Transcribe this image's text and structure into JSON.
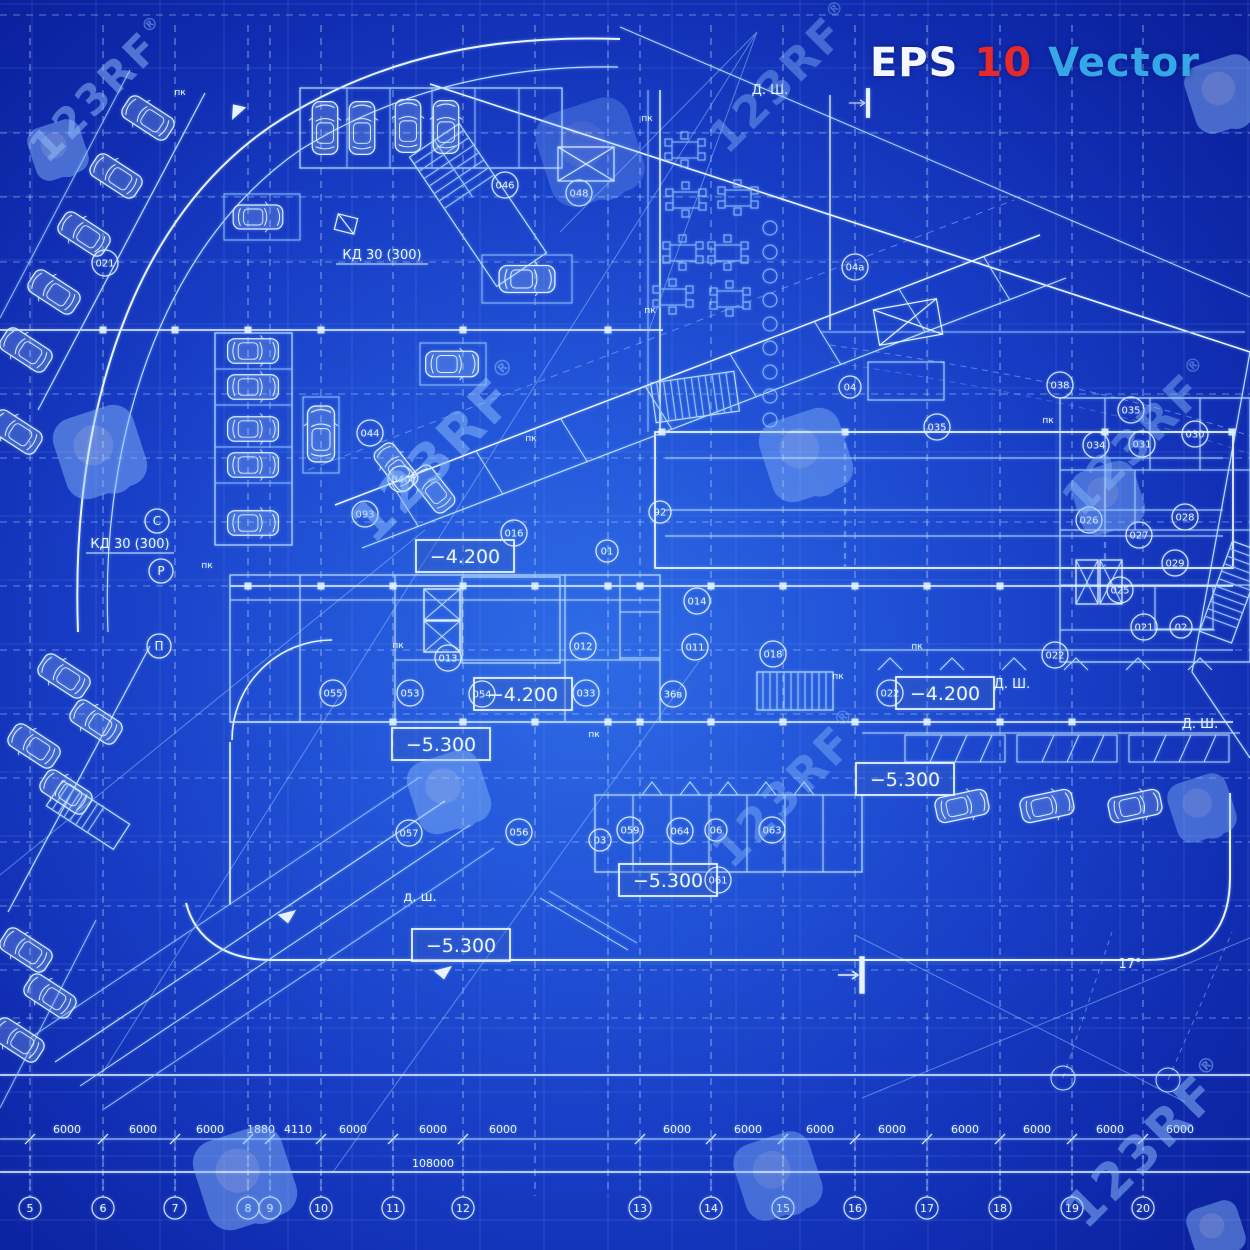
{
  "header": {
    "eps_label": "EPS",
    "version_label": "10",
    "vector_label": "Vector",
    "eps_color": "#f4f7ff",
    "version_color": "#e62a2a",
    "vector_color": "#35a7e8"
  },
  "watermark": {
    "text": "123RF",
    "reg_mark": "®",
    "color": "#8fc0ff",
    "text_items": [
      {
        "x": 112,
        "y": 100,
        "size": 42,
        "o": 0.5
      },
      {
        "x": 795,
        "y": 88,
        "size": 44,
        "o": 0.4
      },
      {
        "x": 455,
        "y": 464,
        "size": 54,
        "o": 0.5
      },
      {
        "x": 1152,
        "y": 448,
        "size": 46,
        "o": 0.42
      },
      {
        "x": 802,
        "y": 800,
        "size": 46,
        "o": 0.4
      },
      {
        "x": 1162,
        "y": 1155,
        "size": 50,
        "o": 0.5
      }
    ],
    "logo_items": [
      {
        "x": 58,
        "y": 150,
        "s": 0.62,
        "o": 0.45
      },
      {
        "x": 590,
        "y": 152,
        "s": 1.1,
        "o": 0.25
      },
      {
        "x": 1224,
        "y": 94,
        "s": 0.8,
        "o": 0.45
      },
      {
        "x": 100,
        "y": 452,
        "s": 0.95,
        "o": 0.45
      },
      {
        "x": 806,
        "y": 455,
        "s": 0.95,
        "o": 0.4
      },
      {
        "x": 1108,
        "y": 498,
        "s": 0.75,
        "o": 0.4
      },
      {
        "x": 449,
        "y": 792,
        "s": 0.85,
        "o": 0.42
      },
      {
        "x": 1202,
        "y": 808,
        "s": 0.7,
        "o": 0.4
      },
      {
        "x": 245,
        "y": 1178,
        "s": 1.05,
        "o": 0.45
      },
      {
        "x": 778,
        "y": 1176,
        "s": 0.9,
        "o": 0.4
      },
      {
        "x": 1216,
        "y": 1230,
        "s": 0.6,
        "o": 0.45
      }
    ]
  },
  "plan": {
    "elevation_boxes": [
      {
        "text": "−4.200",
        "x": 465,
        "y": 557
      },
      {
        "text": "−4.200",
        "x": 523,
        "y": 695
      },
      {
        "text": "−4.200",
        "x": 945,
        "y": 694
      },
      {
        "text": "−5.300",
        "x": 441,
        "y": 745
      },
      {
        "text": "−5.300",
        "x": 905,
        "y": 780
      },
      {
        "text": "−5.300",
        "x": 668,
        "y": 881
      },
      {
        "text": "−5.300",
        "x": 461,
        "y": 946
      }
    ],
    "room_labels": [
      {
        "text": "046",
        "x": 505,
        "y": 185
      },
      {
        "text": "048",
        "x": 579,
        "y": 193
      },
      {
        "text": "04",
        "x": 850,
        "y": 387
      },
      {
        "text": "04а",
        "x": 855,
        "y": 267
      },
      {
        "text": "035",
        "x": 937,
        "y": 427
      },
      {
        "text": "038",
        "x": 1060,
        "y": 385
      },
      {
        "text": "044",
        "x": 370,
        "y": 433
      },
      {
        "text": "040",
        "x": 401,
        "y": 479
      },
      {
        "text": "093",
        "x": 365,
        "y": 514
      },
      {
        "text": "016",
        "x": 514,
        "y": 533
      },
      {
        "text": "01",
        "x": 607,
        "y": 551
      },
      {
        "text": "92",
        "x": 660,
        "y": 512
      },
      {
        "text": "012",
        "x": 583,
        "y": 646
      },
      {
        "text": "011",
        "x": 695,
        "y": 647
      },
      {
        "text": "018",
        "x": 773,
        "y": 654
      },
      {
        "text": "013",
        "x": 448,
        "y": 658
      },
      {
        "text": "014",
        "x": 697,
        "y": 601
      },
      {
        "text": "033",
        "x": 586,
        "y": 693
      },
      {
        "text": "36в",
        "x": 673,
        "y": 694
      },
      {
        "text": "053",
        "x": 410,
        "y": 693
      },
      {
        "text": "054",
        "x": 482,
        "y": 694
      },
      {
        "text": "055",
        "x": 333,
        "y": 693
      },
      {
        "text": "057",
        "x": 409,
        "y": 833
      },
      {
        "text": "056",
        "x": 519,
        "y": 832
      },
      {
        "text": "03",
        "x": 600,
        "y": 840
      },
      {
        "text": "059",
        "x": 630,
        "y": 830
      },
      {
        "text": "064",
        "x": 680,
        "y": 831
      },
      {
        "text": "06",
        "x": 716,
        "y": 830
      },
      {
        "text": "063",
        "x": 772,
        "y": 830
      },
      {
        "text": "061",
        "x": 718,
        "y": 880
      },
      {
        "text": "022",
        "x": 890,
        "y": 693
      },
      {
        "text": "022",
        "x": 1055,
        "y": 655
      },
      {
        "text": "021",
        "x": 1144,
        "y": 627
      },
      {
        "text": "02",
        "x": 1181,
        "y": 627
      },
      {
        "text": "035",
        "x": 1131,
        "y": 410
      },
      {
        "text": "034",
        "x": 1096,
        "y": 445
      },
      {
        "text": "031",
        "x": 1142,
        "y": 444
      },
      {
        "text": "030",
        "x": 1195,
        "y": 434
      },
      {
        "text": "026",
        "x": 1089,
        "y": 520
      },
      {
        "text": "027",
        "x": 1139,
        "y": 535
      },
      {
        "text": "028",
        "x": 1185,
        "y": 517
      },
      {
        "text": "029",
        "x": 1175,
        "y": 563
      },
      {
        "text": "025",
        "x": 1120,
        "y": 590
      },
      {
        "text": "021",
        "x": 105,
        "y": 263
      }
    ],
    "axis_letter_labels": [
      {
        "text": "С",
        "x": 157,
        "y": 521
      },
      {
        "text": "Р",
        "x": 161,
        "y": 571
      },
      {
        "text": "П",
        "x": 159,
        "y": 646
      }
    ],
    "note_labels": [
      {
        "text": "КД 30 (300)",
        "x": 382,
        "y": 259,
        "underline": 92
      },
      {
        "text": "КД 30 (300)",
        "x": 130,
        "y": 548,
        "underline": 88
      },
      {
        "text": "Д. Ш.",
        "x": 770,
        "y": 94
      },
      {
        "text": "Д. Ш.",
        "x": 1012,
        "y": 688
      },
      {
        "text": "Д. Ш.",
        "x": 1200,
        "y": 728
      },
      {
        "text": "д. ш.",
        "x": 420,
        "y": 901
      },
      {
        "text": "17°",
        "x": 1130,
        "y": 968
      }
    ],
    "pk_text": "пк",
    "pk_labels": [
      {
        "x": 647,
        "y": 121
      },
      {
        "x": 650,
        "y": 313
      },
      {
        "x": 207,
        "y": 568
      },
      {
        "x": 838,
        "y": 679
      },
      {
        "x": 1048,
        "y": 423
      },
      {
        "x": 594,
        "y": 737
      },
      {
        "x": 398,
        "y": 648
      },
      {
        "x": 917,
        "y": 649
      },
      {
        "x": 531,
        "y": 441
      },
      {
        "x": 180,
        "y": 95
      }
    ],
    "cars": [
      {
        "x": 325,
        "y": 128,
        "r": 0,
        "s": 0.85
      },
      {
        "x": 362,
        "y": 128,
        "r": 0,
        "s": 0.85
      },
      {
        "x": 408,
        "y": 126,
        "r": 0,
        "s": 0.85
      },
      {
        "x": 446,
        "y": 127,
        "r": 0,
        "s": 0.85
      },
      {
        "x": 258,
        "y": 217,
        "r": 90,
        "s": 0.8
      },
      {
        "x": 527,
        "y": 279,
        "r": 90,
        "s": 0.9
      },
      {
        "x": 452,
        "y": 364,
        "r": 90,
        "s": 0.85
      },
      {
        "x": 253,
        "y": 351,
        "r": 90,
        "s": 0.82
      },
      {
        "x": 253,
        "y": 387,
        "r": 90,
        "s": 0.82
      },
      {
        "x": 253,
        "y": 429,
        "r": 90,
        "s": 0.82
      },
      {
        "x": 253,
        "y": 465,
        "r": 90,
        "s": 0.82
      },
      {
        "x": 253,
        "y": 523,
        "r": 90,
        "s": 0.82
      },
      {
        "x": 321,
        "y": 434,
        "r": 0,
        "s": 0.9
      },
      {
        "x": 396,
        "y": 467,
        "r": -38,
        "s": 0.8
      },
      {
        "x": 433,
        "y": 489,
        "r": -38,
        "s": 0.8
      },
      {
        "x": 962,
        "y": 806,
        "r": 78,
        "s": 0.85
      },
      {
        "x": 1047,
        "y": 806,
        "r": 78,
        "s": 0.85
      },
      {
        "x": 1135,
        "y": 806,
        "r": 78,
        "s": 0.85
      },
      {
        "x": 148,
        "y": 118,
        "r": -57,
        "s": 0.85
      },
      {
        "x": 116,
        "y": 176,
        "r": -57,
        "s": 0.85
      },
      {
        "x": 84,
        "y": 234,
        "r": -57,
        "s": 0.85
      },
      {
        "x": 54,
        "y": 292,
        "r": -57,
        "s": 0.85
      },
      {
        "x": 26,
        "y": 350,
        "r": -57,
        "s": 0.85
      },
      {
        "x": 16,
        "y": 432,
        "r": -57,
        "s": 0.85
      },
      {
        "x": 64,
        "y": 676,
        "r": -57,
        "s": 0.85
      },
      {
        "x": 96,
        "y": 722,
        "r": -57,
        "s": 0.85
      },
      {
        "x": 34,
        "y": 746,
        "r": -57,
        "s": 0.85
      },
      {
        "x": 66,
        "y": 792,
        "r": -57,
        "s": 0.85
      },
      {
        "x": 26,
        "y": 950,
        "r": -57,
        "s": 0.85
      },
      {
        "x": 50,
        "y": 996,
        "r": -57,
        "s": 0.85
      },
      {
        "x": 18,
        "y": 1040,
        "r": -57,
        "s": 0.85
      }
    ],
    "grid": {
      "bubble_y": 1208,
      "bubbles": [
        {
          "label": "5",
          "x": 30
        },
        {
          "label": "6",
          "x": 103
        },
        {
          "label": "7",
          "x": 175
        },
        {
          "label": "8",
          "x": 248
        },
        {
          "label": "9",
          "x": 270
        },
        {
          "label": "10",
          "x": 321
        },
        {
          "label": "11",
          "x": 393
        },
        {
          "label": "12",
          "x": 463
        },
        {
          "label": "13",
          "x": 640
        },
        {
          "label": "14",
          "x": 711
        },
        {
          "label": "15",
          "x": 783
        },
        {
          "label": "16",
          "x": 855
        },
        {
          "label": "17",
          "x": 927
        },
        {
          "label": "18",
          "x": 1000
        },
        {
          "label": "19",
          "x": 1072
        },
        {
          "label": "20",
          "x": 1143
        }
      ],
      "dim_y": 1133,
      "dims": [
        {
          "text": "6000",
          "x": 67
        },
        {
          "text": "6000",
          "x": 143
        },
        {
          "text": "6000",
          "x": 210
        },
        {
          "text": "1880",
          "x": 261
        },
        {
          "text": "4110",
          "x": 298
        },
        {
          "text": "6000",
          "x": 353
        },
        {
          "text": "6000",
          "x": 433
        },
        {
          "text": "6000",
          "x": 503
        },
        {
          "text": "6000",
          "x": 677
        },
        {
          "text": "6000",
          "x": 748
        },
        {
          "text": "6000",
          "x": 820
        },
        {
          "text": "6000",
          "x": 892
        },
        {
          "text": "6000",
          "x": 965
        },
        {
          "text": "6000",
          "x": 1037
        },
        {
          "text": "6000",
          "x": 1110
        },
        {
          "text": "6000",
          "x": 1180
        }
      ],
      "total_dim": {
        "text": "108000",
        "x": 433,
        "y": 1167
      }
    }
  }
}
